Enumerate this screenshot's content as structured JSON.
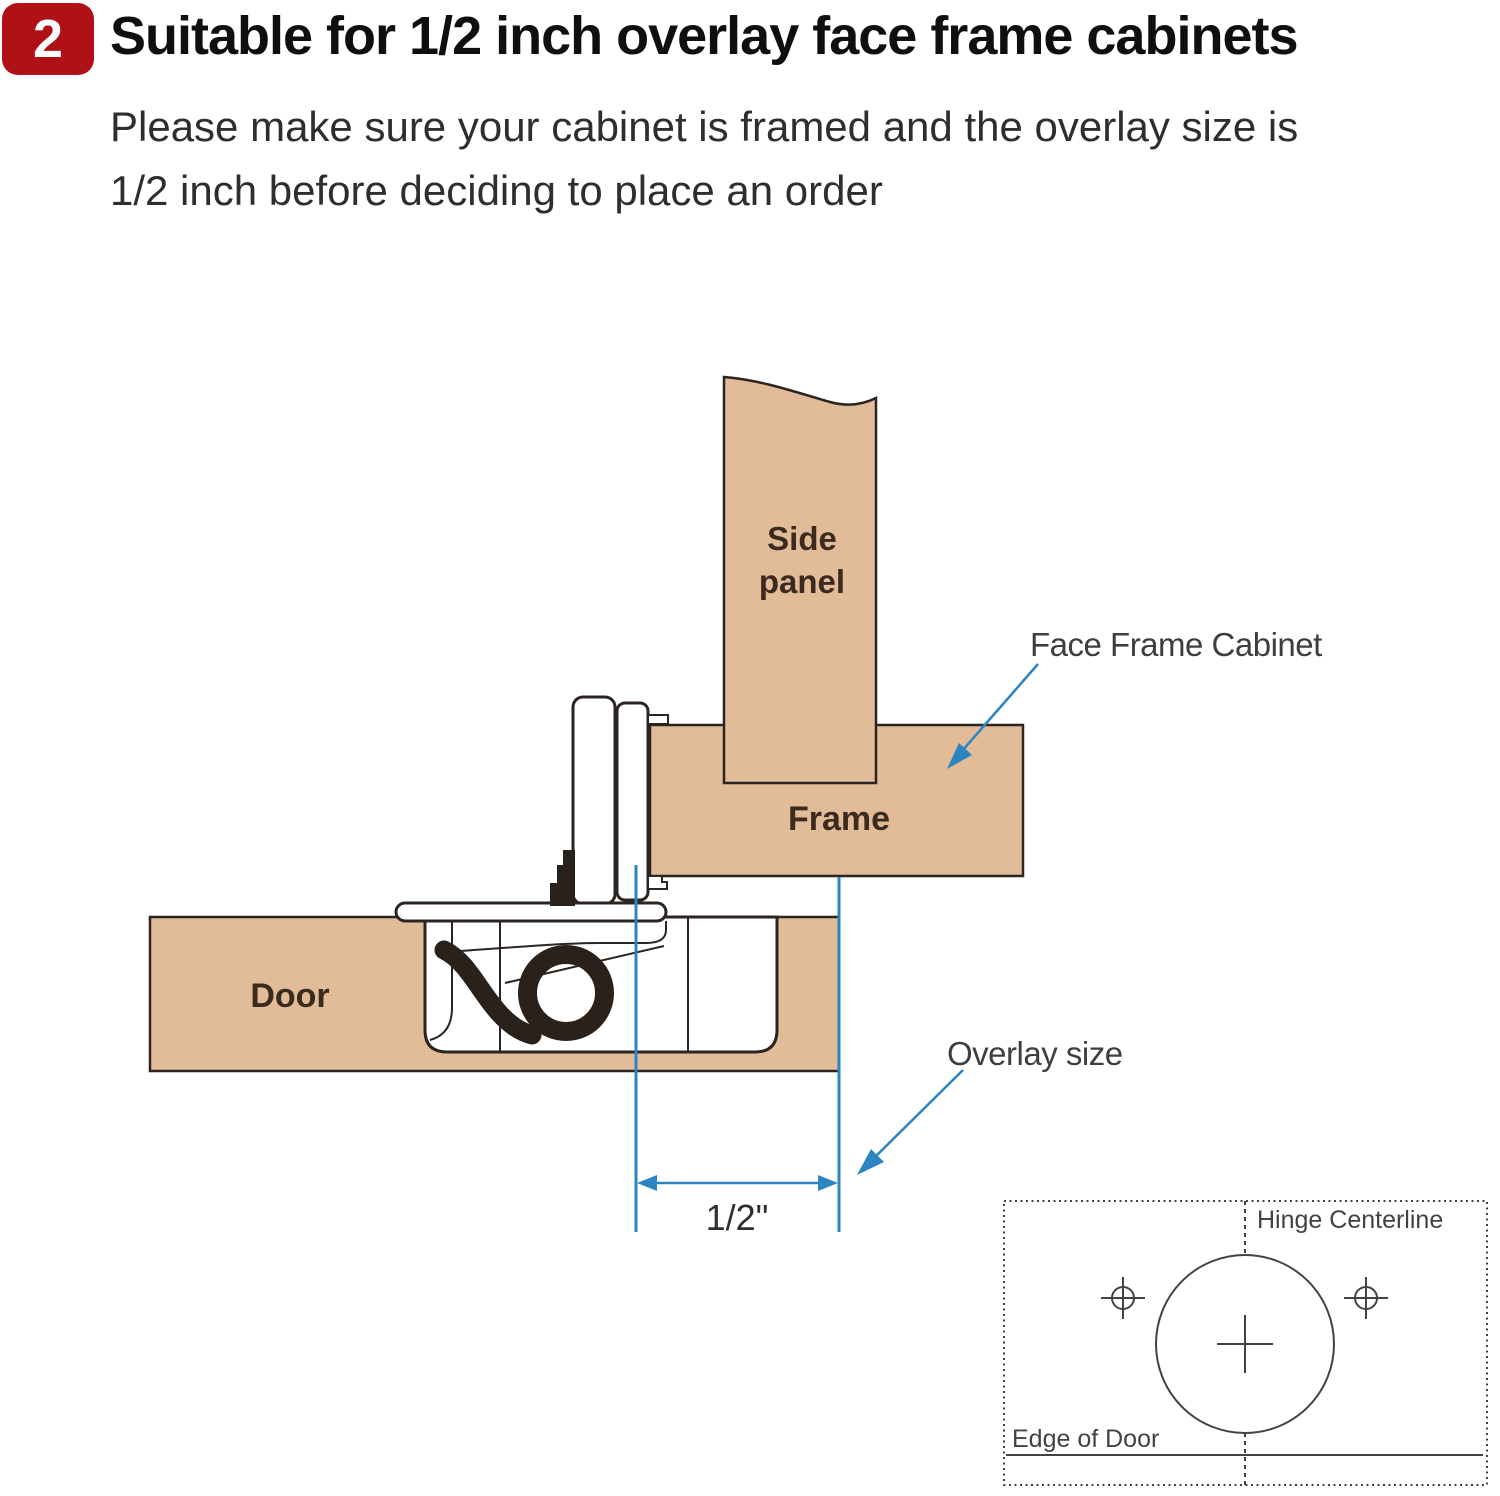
{
  "header": {
    "step_number": "2",
    "title": "Suitable for 1/2 inch overlay face frame cabinets",
    "subtitle_line1": "Please make sure your cabinet is framed and the overlay size is",
    "subtitle_line2": "1/2 inch before deciding to place an order"
  },
  "diagram": {
    "labels": {
      "side_panel_line1": "Side",
      "side_panel_line2": "panel",
      "frame": "Frame",
      "door": "Door",
      "face_frame_cabinet": "Face Frame Cabinet",
      "overlay_size": "Overlay size",
      "overlay_dimension": "1/2\""
    },
    "inset": {
      "hinge_centerline_label": "Hinge Centerline",
      "edge_of_door_label": "Edge of Door"
    },
    "colors": {
      "wood": "#e2bc98",
      "outline": "#2b2420",
      "blue": "#2b85c0",
      "hinge_black": "#2a211b",
      "badge_red": "#b01116",
      "label_brown": "#3b2a1e",
      "annotation_gray": "#3e3e3e",
      "inset_gray": "#424242"
    }
  }
}
